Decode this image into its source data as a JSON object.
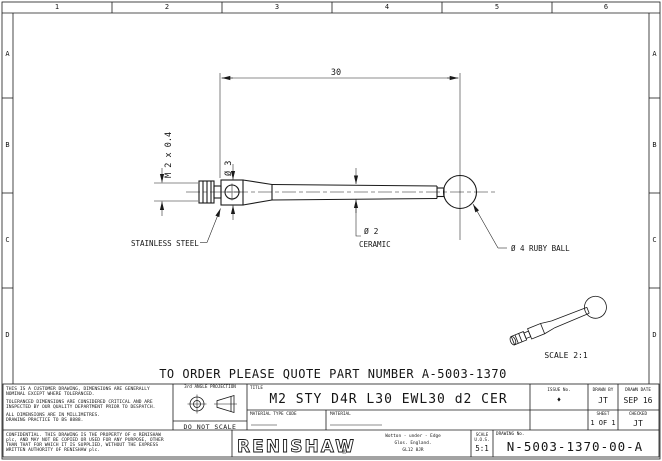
{
  "border": {
    "top_zones": [
      "1",
      "2",
      "3",
      "4",
      "5",
      "6"
    ],
    "side_zones": [
      "A",
      "B",
      "C",
      "D"
    ]
  },
  "drawing": {
    "dim_length": "30",
    "dim_thread": "M 2 x 0.4",
    "dim_stem_dia": "Ø 3",
    "label_holder_material": "STAINLESS STEEL",
    "label_stem_dia": "Ø 2",
    "label_stem_material": "CERAMIC",
    "label_ball": "Ø 4 RUBY BALL",
    "iso_scale_note": "SCALE 2:1"
  },
  "order_note": "TO ORDER PLEASE QUOTE PART NUMBER A-5003-1370",
  "title_block": {
    "notes": [
      "THIS IS A CUSTOMER DRAWING, DIMENSIONS ARE GENERALLY NOMINAL EXCEPT WHERE TOLERANCED.",
      "TOLERANCED DIMENSIONS ARE CONSIDERED CRITICAL AND ARE INSPECTED BY OUR QUALITY DEPARTMENT PRIOR TO DESPATCH.",
      "ALL DIMENSIONS ARE IN MILLIMETRES.",
      "DRAWING PRACTICE TO BS 8888."
    ],
    "confidential": "CONFIDENTIAL. THIS DRAWING IS THE PROPERTY OF © RENISHAW plc, AND MAY NOT BE COPIED OR USED FOR ANY PURPOSE, OTHER THAN THAT FOR WHICH IT IS SUPPLIED, WITHOUT THE EXPRESS WRITTEN AUTHORITY OF RENISHAW plc.",
    "projection_label": "3rd ANGLE PROJECTION",
    "do_not_scale": "DO NOT SCALE",
    "title_label": "TITLE",
    "title": "M2 STY D4R L30 EWL30 d2 CER",
    "material_type_code_label": "MATERIAL TYPE CODE",
    "material_label": "MATERIAL",
    "issue_label": "ISSUE No.",
    "issue_value": "♦",
    "drawn_by_label": "DRAWN BY",
    "drawn_by": "JT",
    "drawn_date_label": "DRAWN DATE",
    "drawn_date": "SEP 16",
    "sheet_label": "SHEET",
    "sheet": "1 OF 1",
    "checked_label": "CHECKED",
    "checked": "JT",
    "company": "RENISHAW",
    "registered_mark": "®",
    "address": [
      "Wotton - under - Edge",
      "Glos. England.",
      "GL12 8JR"
    ],
    "scale_label": "SCALE",
    "scale_uos_label": "U.O.S.",
    "scale_value": "5:1",
    "drawing_no_label": "DRAWING No.",
    "drawing_no": "N-5003-1370-00-A"
  },
  "colors": {
    "line": "#1a1a1a",
    "background": "#ffffff"
  }
}
